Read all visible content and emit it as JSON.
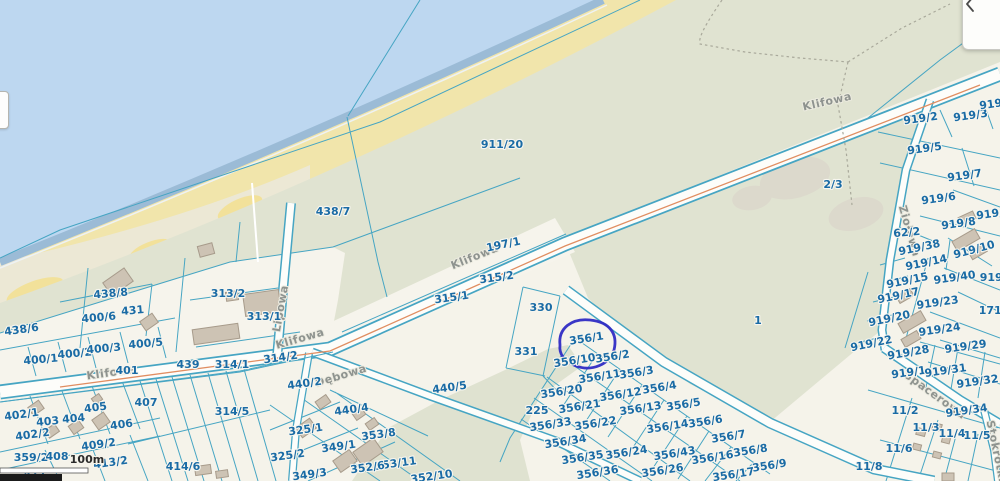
{
  "app": {
    "type": "cadastral-map-viewer"
  },
  "panel": {
    "icon": "chevron-left"
  },
  "scalebar": {
    "label": "100m"
  },
  "annotation": {
    "highlight_parcel": "356/1",
    "shape": "hand-drawn-ellipse"
  },
  "colors": {
    "sea": "#bdd7f0",
    "shore_band": "#9bbbd6",
    "beach_sand": "#f1e5ab",
    "beach_pale": "#ebe8d8",
    "land_green": "#e0e3d1",
    "land_cream": "#f5f3ea",
    "grey_patch": "#dcd8cc",
    "road_fill": "#fdfdfa",
    "boundary": "#46a5c3",
    "road_centerline": "#e08e62",
    "parcel_label": "#1a6ba5",
    "street_label": "#8e938f",
    "building_fill": "#cdc3b4",
    "building_stroke": "#a79b8b",
    "annotation_blue": "#2f2bc4",
    "scalebar_dark": "#1b1b1b"
  },
  "street_labels": [
    {
      "t": "Klifowa",
      "x": 828,
      "y": 105,
      "r": -13
    },
    {
      "t": "Klifowa",
      "x": 476,
      "y": 260,
      "r": -22
    },
    {
      "t": "Klifowa",
      "x": 301,
      "y": 342,
      "r": -16
    },
    {
      "t": "Klifowa",
      "x": 112,
      "y": 376,
      "r": -8
    },
    {
      "t": "Lipowa",
      "x": 284,
      "y": 309,
      "r": -80
    },
    {
      "t": "Dębowa",
      "x": 342,
      "y": 379,
      "r": -17
    },
    {
      "t": "Ziołowa",
      "x": 906,
      "y": 232,
      "r": 74
    },
    {
      "t": "Spacerowa",
      "x": 933,
      "y": 398,
      "r": 36
    },
    {
      "t": "Stokrotki",
      "x": 993,
      "y": 452,
      "r": 78
    }
  ],
  "parcel_labels": [
    {
      "t": "911/20",
      "x": 502,
      "y": 148,
      "s": 12
    },
    {
      "t": "438/7",
      "x": 333,
      "y": 215
    },
    {
      "t": "197/1",
      "x": 504,
      "y": 248,
      "r": -12
    },
    {
      "t": "315/2",
      "x": 497,
      "y": 281,
      "r": -8
    },
    {
      "t": "315/1",
      "x": 452,
      "y": 301,
      "r": -8
    },
    {
      "t": "330",
      "x": 541,
      "y": 311
    },
    {
      "t": "331",
      "x": 526,
      "y": 355
    },
    {
      "t": "1",
      "x": 758,
      "y": 324
    },
    {
      "t": "2/3",
      "x": 833,
      "y": 188
    },
    {
      "t": "438/8",
      "x": 111,
      "y": 297,
      "r": -5
    },
    {
      "t": "431",
      "x": 133,
      "y": 314,
      "r": -5
    },
    {
      "t": "313/2",
      "x": 228,
      "y": 297
    },
    {
      "t": "313/1",
      "x": 264,
      "y": 320
    },
    {
      "t": "400/6",
      "x": 99,
      "y": 321,
      "r": -5
    },
    {
      "t": "438/6",
      "x": 22,
      "y": 333,
      "r": -8
    },
    {
      "t": "400/1",
      "x": 41,
      "y": 363,
      "r": -5
    },
    {
      "t": "400/2",
      "x": 75,
      "y": 357,
      "r": -5
    },
    {
      "t": "400/3",
      "x": 104,
      "y": 352,
      "r": -5
    },
    {
      "t": "400/5",
      "x": 146,
      "y": 347,
      "r": -5
    },
    {
      "t": "401",
      "x": 127,
      "y": 374
    },
    {
      "t": "439",
      "x": 188,
      "y": 368
    },
    {
      "t": "314/1",
      "x": 232,
      "y": 368
    },
    {
      "t": "314/2",
      "x": 281,
      "y": 361,
      "r": -8
    },
    {
      "t": "440/2",
      "x": 305,
      "y": 387,
      "r": -8
    },
    {
      "t": "407",
      "x": 146,
      "y": 406
    },
    {
      "t": "314/5",
      "x": 232,
      "y": 415
    },
    {
      "t": "402/1",
      "x": 22,
      "y": 418,
      "r": -8
    },
    {
      "t": "403",
      "x": 48,
      "y": 425,
      "r": -5
    },
    {
      "t": "404",
      "x": 74,
      "y": 422,
      "r": -5
    },
    {
      "t": "405",
      "x": 96,
      "y": 411,
      "r": -8
    },
    {
      "t": "406",
      "x": 122,
      "y": 428,
      "r": -8
    },
    {
      "t": "402/2",
      "x": 33,
      "y": 438,
      "r": -8
    },
    {
      "t": "409/2",
      "x": 99,
      "y": 448,
      "r": -8
    },
    {
      "t": "359/2",
      "x": 31,
      "y": 461
    },
    {
      "t": "408",
      "x": 57,
      "y": 460
    },
    {
      "t": "413/2",
      "x": 111,
      "y": 466,
      "r": -8
    },
    {
      "t": "411",
      "x": 35,
      "y": 478
    },
    {
      "t": "414/6",
      "x": 183,
      "y": 470
    },
    {
      "t": "440/4",
      "x": 352,
      "y": 413,
      "r": -8
    },
    {
      "t": "440/5",
      "x": 450,
      "y": 391,
      "r": -8
    },
    {
      "t": "325/1",
      "x": 306,
      "y": 433,
      "r": -8
    },
    {
      "t": "353/8",
      "x": 379,
      "y": 438,
      "r": -8
    },
    {
      "t": "349/1",
      "x": 339,
      "y": 450,
      "r": -8
    },
    {
      "t": "325/2",
      "x": 288,
      "y": 459,
      "r": -8
    },
    {
      "t": "353/11",
      "x": 396,
      "y": 467,
      "r": -8
    },
    {
      "t": "352/6",
      "x": 368,
      "y": 471,
      "r": -8
    },
    {
      "t": "349/3",
      "x": 310,
      "y": 478,
      "r": -8
    },
    {
      "t": "352/10",
      "x": 432,
      "y": 480,
      "r": -8
    },
    {
      "t": "225",
      "x": 537,
      "y": 414
    },
    {
      "t": "356/1",
      "x": 587,
      "y": 342,
      "r": -9
    },
    {
      "t": "356/10",
      "x": 575,
      "y": 364,
      "r": -9
    },
    {
      "t": "356/2",
      "x": 613,
      "y": 360,
      "r": -9
    },
    {
      "t": "356/11",
      "x": 600,
      "y": 380,
      "r": -9
    },
    {
      "t": "356/3",
      "x": 637,
      "y": 376,
      "r": -9
    },
    {
      "t": "356/20",
      "x": 562,
      "y": 395,
      "r": -9
    },
    {
      "t": "356/12",
      "x": 621,
      "y": 398,
      "r": -9
    },
    {
      "t": "356/4",
      "x": 660,
      "y": 391,
      "r": -9
    },
    {
      "t": "356/21",
      "x": 580,
      "y": 410,
      "r": -9
    },
    {
      "t": "356/13",
      "x": 641,
      "y": 412,
      "r": -9
    },
    {
      "t": "356/5",
      "x": 684,
      "y": 408,
      "r": -9
    },
    {
      "t": "356/33",
      "x": 551,
      "y": 428,
      "r": -9
    },
    {
      "t": "356/22",
      "x": 596,
      "y": 427,
      "r": -9
    },
    {
      "t": "356/14",
      "x": 668,
      "y": 430,
      "r": -9
    },
    {
      "t": "356/6",
      "x": 706,
      "y": 425,
      "r": -9
    },
    {
      "t": "356/34",
      "x": 566,
      "y": 445,
      "r": -9
    },
    {
      "t": "356/7",
      "x": 729,
      "y": 440,
      "r": -9
    },
    {
      "t": "356/35",
      "x": 583,
      "y": 461,
      "r": -9
    },
    {
      "t": "356/24",
      "x": 627,
      "y": 456,
      "r": -9
    },
    {
      "t": "356/43",
      "x": 675,
      "y": 457,
      "r": -9
    },
    {
      "t": "356/16",
      "x": 713,
      "y": 461,
      "r": -9
    },
    {
      "t": "356/8",
      "x": 751,
      "y": 454,
      "r": -9
    },
    {
      "t": "356/36",
      "x": 598,
      "y": 476,
      "r": -9
    },
    {
      "t": "356/26",
      "x": 663,
      "y": 474,
      "r": -9
    },
    {
      "t": "356/17",
      "x": 734,
      "y": 478,
      "r": -9
    },
    {
      "t": "356/9",
      "x": 770,
      "y": 469,
      "r": -9
    },
    {
      "t": "919/2",
      "x": 921,
      "y": 122,
      "r": -8
    },
    {
      "t": "919/3",
      "x": 971,
      "y": 119,
      "r": -8
    },
    {
      "t": "919/1",
      "x": 997,
      "y": 107,
      "r": -8
    },
    {
      "t": "919/5",
      "x": 925,
      "y": 152,
      "r": -8
    },
    {
      "t": "919/7",
      "x": 965,
      "y": 179,
      "r": -8
    },
    {
      "t": "919/6",
      "x": 939,
      "y": 202,
      "r": -8
    },
    {
      "t": "62/2",
      "x": 907,
      "y": 236,
      "r": -5
    },
    {
      "t": "919/8",
      "x": 959,
      "y": 227,
      "r": -8
    },
    {
      "t": "919/9",
      "x": 994,
      "y": 217,
      "r": -8
    },
    {
      "t": "919/38",
      "x": 920,
      "y": 251,
      "r": -12
    },
    {
      "t": "919/10",
      "x": 975,
      "y": 253,
      "r": -15
    },
    {
      "t": "919/14",
      "x": 927,
      "y": 266,
      "r": -12
    },
    {
      "t": "919/15",
      "x": 908,
      "y": 284,
      "r": -12
    },
    {
      "t": "919/40",
      "x": 955,
      "y": 281,
      "r": -8
    },
    {
      "t": "919/1",
      "x": 997,
      "y": 281
    },
    {
      "t": "919/17",
      "x": 899,
      "y": 299,
      "r": -12
    },
    {
      "t": "919/23",
      "x": 938,
      "y": 306,
      "r": -8
    },
    {
      "t": "171/1",
      "x": 996,
      "y": 314
    },
    {
      "t": "919/20",
      "x": 890,
      "y": 322,
      "r": -12
    },
    {
      "t": "919/24",
      "x": 940,
      "y": 333,
      "r": -8
    },
    {
      "t": "919/22",
      "x": 872,
      "y": 347,
      "r": -12
    },
    {
      "t": "919/29",
      "x": 966,
      "y": 350,
      "r": -8
    },
    {
      "t": "919/28",
      "x": 909,
      "y": 356,
      "r": -10
    },
    {
      "t": "919/1",
      "x": 909,
      "y": 376,
      "r": -8
    },
    {
      "t": "919/31",
      "x": 946,
      "y": 374,
      "r": -8
    },
    {
      "t": "919/32",
      "x": 978,
      "y": 385,
      "r": -8
    },
    {
      "t": "919/34",
      "x": 967,
      "y": 414,
      "r": -8
    },
    {
      "t": "11/2",
      "x": 905,
      "y": 414
    },
    {
      "t": "11/3",
      "x": 926,
      "y": 431
    },
    {
      "t": "11/4",
      "x": 952,
      "y": 437
    },
    {
      "t": "11/5",
      "x": 977,
      "y": 439
    },
    {
      "t": "11/6",
      "x": 899,
      "y": 452
    },
    {
      "t": "11/8",
      "x": 869,
      "y": 470
    }
  ]
}
